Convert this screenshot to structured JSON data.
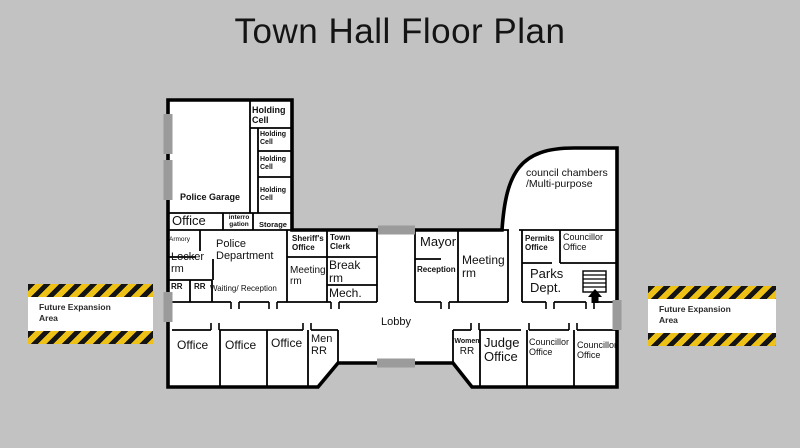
{
  "title": "Town Hall Floor Plan",
  "colors": {
    "background": "#c2c2c2",
    "walls": "#000000",
    "room_fill": "#ffffff",
    "door_gray": "#9b9b9b",
    "hazard_yellow": "#eec117",
    "hazard_black": "#141414"
  },
  "rooms": [
    {
      "name": "police-garage",
      "label": "Police Garage"
    },
    {
      "name": "holding-cell-main",
      "label": "Holding\nCell"
    },
    {
      "name": "holding-cell-2",
      "label": "Holding\nCell"
    },
    {
      "name": "holding-cell-3",
      "label": "Holding\nCell"
    },
    {
      "name": "holding-cell-4",
      "label": "Holding\nCell"
    },
    {
      "name": "police-office",
      "label": "Office"
    },
    {
      "name": "interrogation",
      "label": "interro\ngation"
    },
    {
      "name": "storage",
      "label": "Storage"
    },
    {
      "name": "armory",
      "label": "Armory"
    },
    {
      "name": "police-department",
      "label": "Police\nDepartment"
    },
    {
      "name": "locker-rm",
      "label": "Locker\nrm"
    },
    {
      "name": "rr-1",
      "label": "RR"
    },
    {
      "name": "rr-2",
      "label": "RR"
    },
    {
      "name": "waiting-reception",
      "label": "Waiting/ Reception"
    },
    {
      "name": "sheriffs-office",
      "label": "Sheriff's\nOffice"
    },
    {
      "name": "town-clerk",
      "label": "Town\nClerk"
    },
    {
      "name": "meeting-rm-west",
      "label": "Meeting\nrm"
    },
    {
      "name": "break-rm",
      "label": "Break\nrm"
    },
    {
      "name": "mech",
      "label": "Mech."
    },
    {
      "name": "mayor",
      "label": "Mayor"
    },
    {
      "name": "reception",
      "label": "Reception"
    },
    {
      "name": "meeting-rm-east",
      "label": "Meeting\nrm"
    },
    {
      "name": "council-chambers",
      "label": "council chambers\n/Multi-purpose"
    },
    {
      "name": "permits-office",
      "label": "Permits\nOffice"
    },
    {
      "name": "councillor-office-1",
      "label": "Councillor\nOffice"
    },
    {
      "name": "parks-dept",
      "label": "Parks\nDept."
    },
    {
      "name": "lobby",
      "label": "Lobby"
    },
    {
      "name": "office-1",
      "label": "Office"
    },
    {
      "name": "office-2",
      "label": "Office"
    },
    {
      "name": "office-3",
      "label": "Office"
    },
    {
      "name": "men-rr",
      "label": "Men\nRR"
    },
    {
      "name": "women-rr",
      "label": "Women\nRR"
    },
    {
      "name": "judge-office",
      "label": "Judge\nOffice"
    },
    {
      "name": "councillor-office-2",
      "label": "Councillor\nOffice"
    },
    {
      "name": "councillor-office-3",
      "label": "Councillor\nOffice"
    }
  ],
  "expansion": {
    "left": "Future Expansion\nArea",
    "right": "Future Expansion\nArea"
  }
}
